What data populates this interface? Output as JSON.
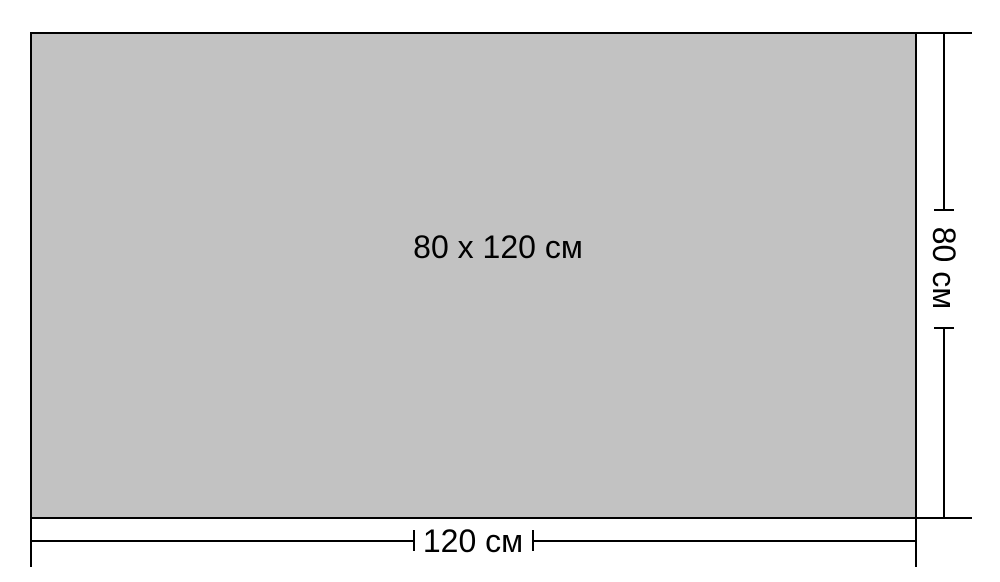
{
  "diagram": {
    "size_label": "80 x 120 см",
    "width_label": "120 см",
    "height_label": "80 см",
    "colors": {
      "background": "#ffffff",
      "rectangle_fill": "#c2c2c2",
      "line": "#000000",
      "text": "#000000"
    }
  }
}
